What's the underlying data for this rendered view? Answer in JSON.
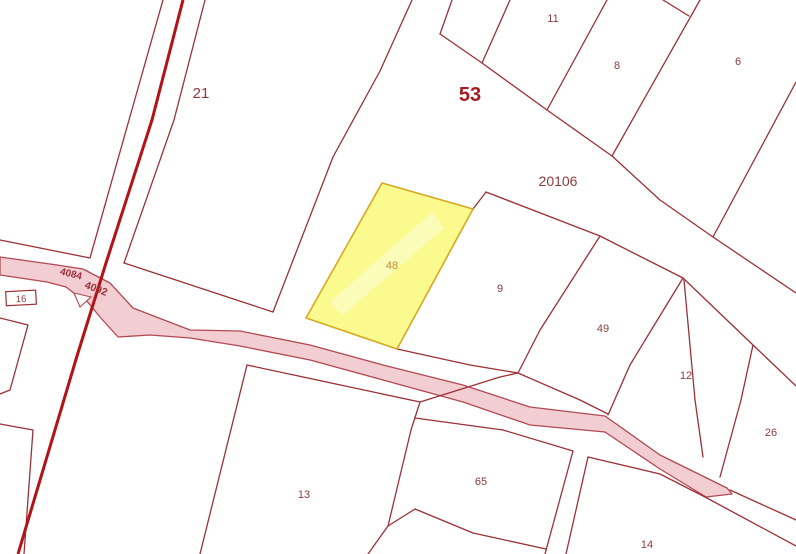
{
  "map": {
    "type": "cadastral-parcel-map",
    "block_number": "53",
    "road_parcel_number": "20106",
    "highlighted_parcel": {
      "number": "48"
    },
    "parcels": [
      {
        "number": "21"
      },
      {
        "number": "11"
      },
      {
        "number": "8"
      },
      {
        "number": "6"
      },
      {
        "number": "9"
      },
      {
        "number": "48"
      },
      {
        "number": "49"
      },
      {
        "number": "12"
      },
      {
        "number": "26"
      },
      {
        "number": "13"
      },
      {
        "number": "65"
      },
      {
        "number": "14"
      },
      {
        "number": "16"
      }
    ],
    "road_labels": [
      {
        "text": "4084"
      },
      {
        "text": "4092"
      }
    ],
    "labels": {
      "block": "53",
      "road_parcel": "20106",
      "p21": "21",
      "p11": "11",
      "p8": "8",
      "p6": "6",
      "p9": "9",
      "p48": "48",
      "p49": "49",
      "p12": "12",
      "p26": "26",
      "p13": "13",
      "p65": "65",
      "p14": "14",
      "p16": "16",
      "road_4084": "4084",
      "road_4092": "4092"
    },
    "colors": {
      "background": "#ffffff",
      "boundary_line": "#9c3036",
      "road_centerline": "#b31217",
      "road_fill": "#f2cdd2",
      "road_outline": "#b04a52",
      "highlight_fill": "#fafa8e",
      "highlight_border": "#d9a720",
      "label_text": "#8e3a3a",
      "block_label_text": "#a31d22",
      "highlight_label_text": "#bf8c2e"
    }
  }
}
